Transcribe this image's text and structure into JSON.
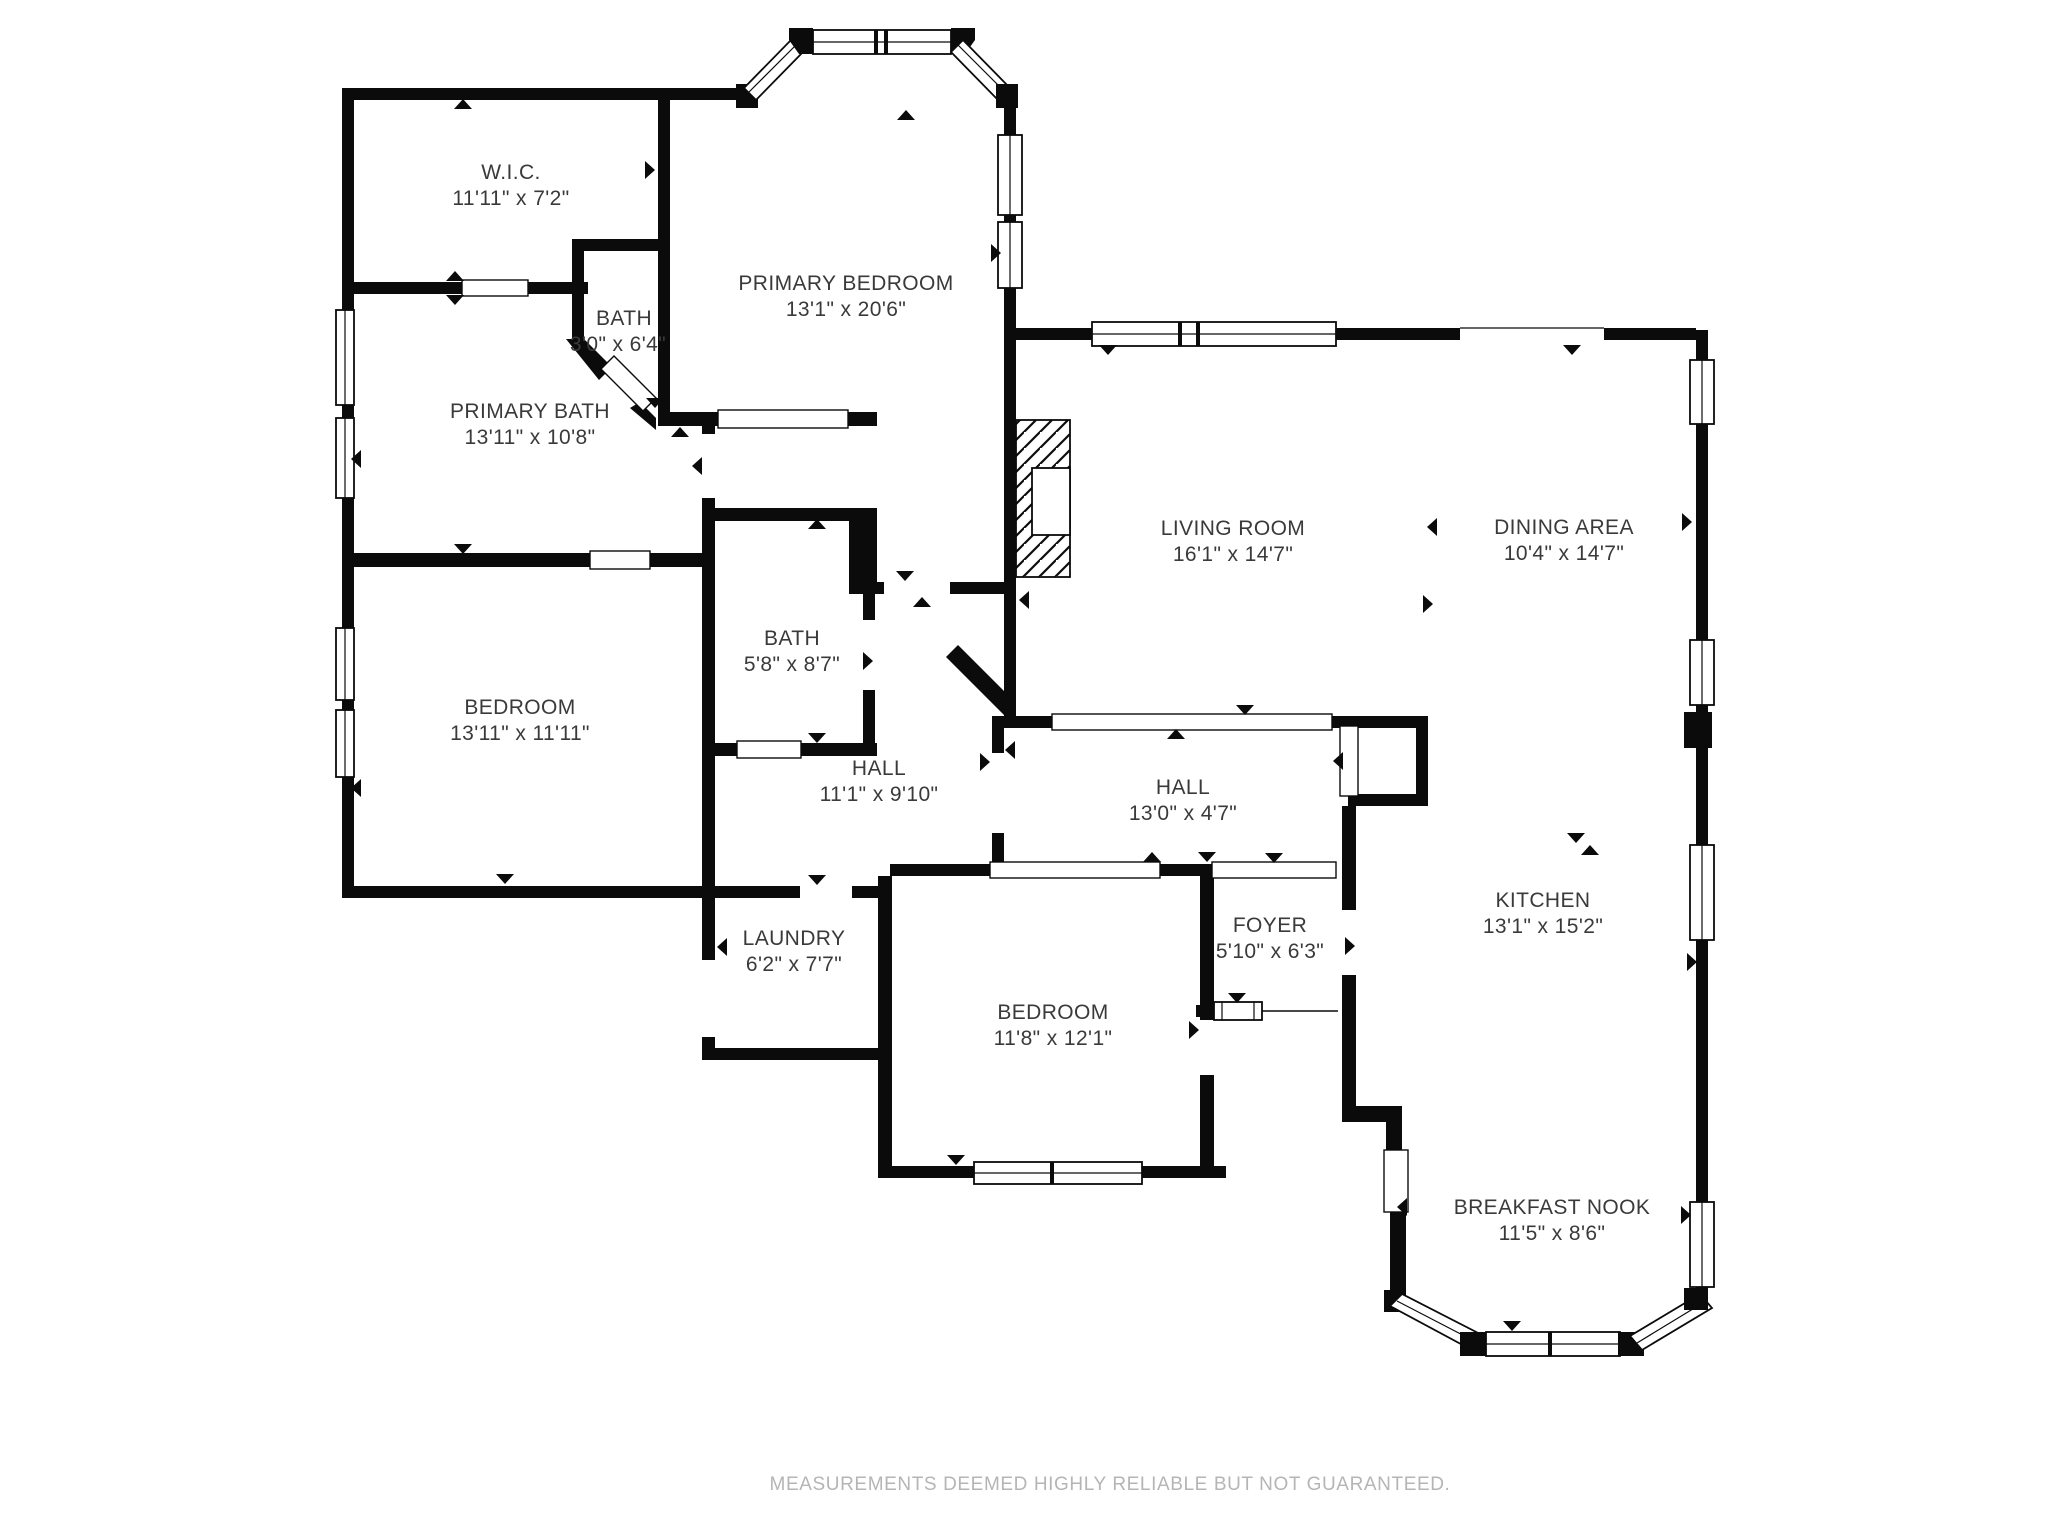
{
  "plan": {
    "wall_color": "#0b0b0b",
    "text_color": "#3a3a3a",
    "footer_color": "#b5b5b5",
    "background": "#ffffff"
  },
  "rooms": [
    {
      "id": "wic",
      "name": "W.I.C.",
      "dims": "11'11\" x 7'2\""
    },
    {
      "id": "bath-small",
      "name": "BATH",
      "dims": "3'0\" x 6'4\""
    },
    {
      "id": "primary-bedroom",
      "name": "PRIMARY BEDROOM",
      "dims": "13'1\" x 20'6\""
    },
    {
      "id": "primary-bath",
      "name": "PRIMARY BATH",
      "dims": "13'11\" x 10'8\""
    },
    {
      "id": "living-room",
      "name": "LIVING ROOM",
      "dims": "16'1\" x 14'7\""
    },
    {
      "id": "dining-area",
      "name": "DINING AREA",
      "dims": "10'4\" x 14'7\""
    },
    {
      "id": "hall-bath",
      "name": "BATH",
      "dims": "5'8\" x 8'7\""
    },
    {
      "id": "bedroom-west",
      "name": "BEDROOM",
      "dims": "13'11\" x 11'11\""
    },
    {
      "id": "hall-west",
      "name": "HALL",
      "dims": "11'1\" x 9'10\""
    },
    {
      "id": "hall-east",
      "name": "HALL",
      "dims": "13'0\" x 4'7\""
    },
    {
      "id": "laundry",
      "name": "LAUNDRY",
      "dims": "6'2\" x 7'7\""
    },
    {
      "id": "foyer",
      "name": "FOYER",
      "dims": "5'10\" x 6'3\""
    },
    {
      "id": "kitchen",
      "name": "KITCHEN",
      "dims": "13'1\" x 15'2\""
    },
    {
      "id": "bedroom-south",
      "name": "BEDROOM",
      "dims": "11'8\" x 12'1\""
    },
    {
      "id": "breakfast-nook",
      "name": "BREAKFAST NOOK",
      "dims": "11'5\" x 8'6\""
    }
  ],
  "footer": {
    "disclaimer": "MEASUREMENTS DEEMED HIGHLY RELIABLE BUT NOT GUARANTEED."
  }
}
